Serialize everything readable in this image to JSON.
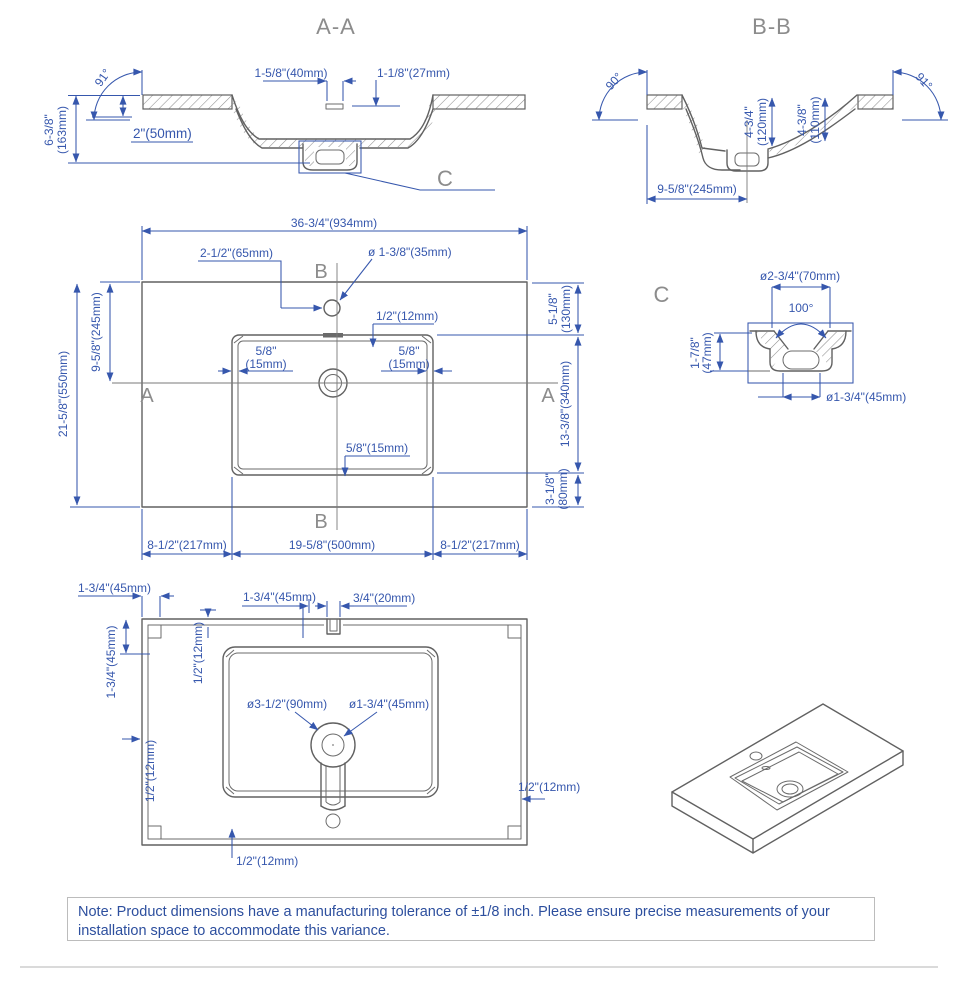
{
  "colors": {
    "dimension_blue": "#3657ad",
    "object_gray": "#616161",
    "title_gray": "#8c8c8c",
    "note_border": "#bcbcbc"
  },
  "sections": {
    "aa": {
      "title": "A-A",
      "angle": "91°",
      "slot": "1-5/8\"(40mm)",
      "overflow": "1-1/8\"(27mm)",
      "thickness": "2\"(50mm)",
      "height_in": "6-3/8\"",
      "height_mm": "(163mm)",
      "detail_ref": "C"
    },
    "bb": {
      "title": "B-B",
      "angle_left": "90°",
      "angle_right": "91°",
      "depth1_in": "4-3/4\"",
      "depth1_mm": "(120mm)",
      "depth2_in": "4-3/8\"",
      "depth2_mm": "(110mm)",
      "width": "9-5/8\"(245mm)"
    },
    "plan": {
      "width": "36-3/4\"(934mm)",
      "faucet_offset": "2-1/2\"(65mm)",
      "faucet_dia": "ø 1-3/8\"(35mm)",
      "rim": "1/2\"(12mm)",
      "lip_in": "5/8\"",
      "lip_mm": "(15mm)",
      "lip_bottom": "5/8\"(15mm)",
      "front": "9-5/8\"(245mm)",
      "depth": "21-5/8\"(550mm)",
      "right_top_in": "5-1/8\"",
      "right_top_mm": "(130mm)",
      "right_mid": "13-3/8\"(340mm)",
      "right_bot_in": "3-1/8\"",
      "right_bot_mm": "(80mm)",
      "bottom_left": "8-1/2\"(217mm)",
      "bottom_center": "19-5/8\"(500mm)",
      "bottom_right": "8-1/2\"(217mm)",
      "marker_a": "A",
      "marker_b": "B"
    },
    "c": {
      "title": "C",
      "dia_top": "ø2-3/4\"(70mm)",
      "angle": "100°",
      "height_in": "1-7/8\"",
      "height_mm": "(47mm)",
      "dia_bottom": "ø1-3/4\"(45mm)"
    },
    "bottom": {
      "notch_w": "1-3/4\"(45mm)",
      "notch_h": "1-3/4\"(45mm)",
      "center_off": "1-3/4\"(45mm)",
      "slot": "3/4\"(20mm)",
      "rim_top": "1/2\"(12mm)",
      "drain_outer": "ø3-1/2\"(90mm)",
      "drain_inner": "ø1-3/4\"(45mm)",
      "rim_left": "1/2\"(12mm)",
      "rim_right": "1/2\"(12mm)",
      "rim_bottom": "1/2\"(12mm)"
    }
  },
  "note": {
    "text": "Note: Product dimensions have a manufacturing tolerance of ±1/8 inch. Please ensure precise measurements of your installation space to accommodate this variance."
  }
}
